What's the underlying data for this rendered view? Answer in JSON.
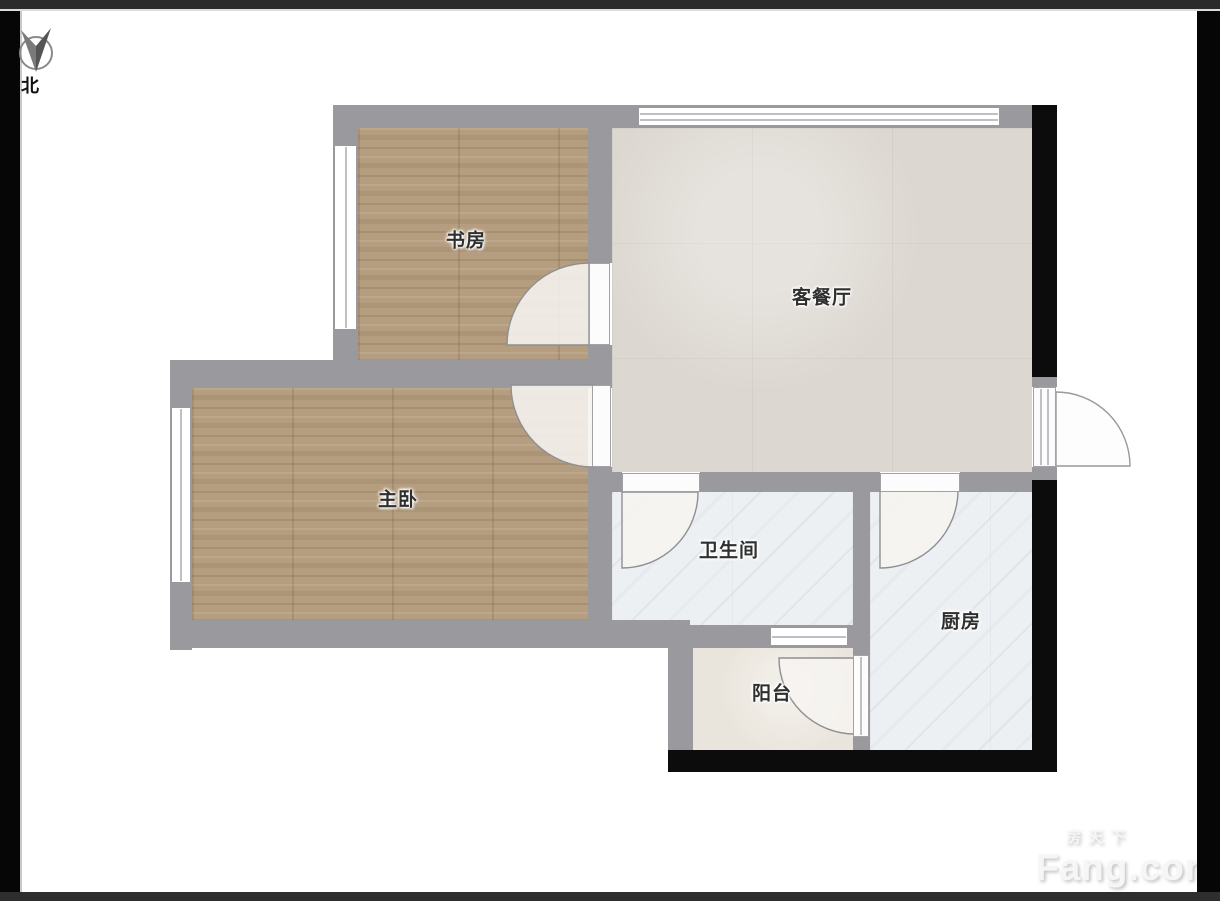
{
  "compass": {
    "label": "北"
  },
  "rooms": [
    {
      "id": "study",
      "label": "书房"
    },
    {
      "id": "living_dining",
      "label": "客餐厅"
    },
    {
      "id": "master_bedroom",
      "label": "主卧"
    },
    {
      "id": "bathroom",
      "label": "卫生间"
    },
    {
      "id": "kitchen",
      "label": "厨房"
    },
    {
      "id": "balcony",
      "label": "阳台"
    }
  ],
  "watermark": {
    "brand_cn": "房天下",
    "brand_en": "Fang.com"
  },
  "palette": {
    "wall": "#9a9a9e",
    "wall-dark": "#0c0c0c",
    "wood": "#b59d7f",
    "tile": "#dcd7d0",
    "marble": "#edf0f3",
    "balcony-floor": "#eae5dc",
    "label-ink": "#2f2f2f"
  }
}
